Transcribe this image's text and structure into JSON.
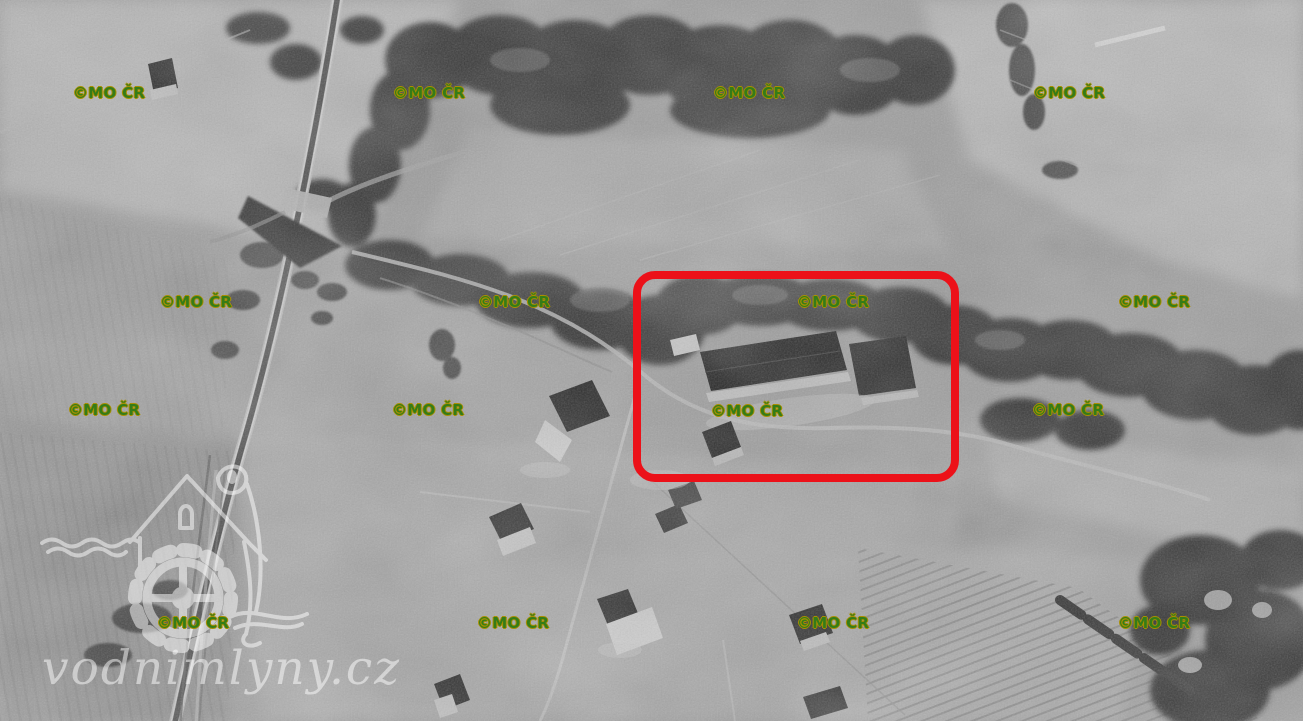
{
  "photo": {
    "kind": "historical black-and-white aerial photograph",
    "highlighted_feature": "water mill buildings"
  },
  "copyright_watermark": {
    "text": "©MO ČR",
    "fill_color": "#357c17",
    "outline_color": "#a98f00",
    "positions": [
      {
        "x": 73,
        "y": 86
      },
      {
        "x": 393,
        "y": 86
      },
      {
        "x": 713,
        "y": 86
      },
      {
        "x": 1033,
        "y": 86
      },
      {
        "x": 160,
        "y": 295
      },
      {
        "x": 478,
        "y": 295
      },
      {
        "x": 797,
        "y": 295
      },
      {
        "x": 1118,
        "y": 295
      },
      {
        "x": 68,
        "y": 403
      },
      {
        "x": 392,
        "y": 403
      },
      {
        "x": 711,
        "y": 404
      },
      {
        "x": 1032,
        "y": 403
      },
      {
        "x": 157,
        "y": 616
      },
      {
        "x": 477,
        "y": 616
      },
      {
        "x": 797,
        "y": 616
      },
      {
        "x": 1118,
        "y": 616
      }
    ]
  },
  "highlight_box": {
    "x": 633,
    "y": 271,
    "width": 326,
    "height": 211,
    "border_color": "#ec1119",
    "border_width": 8,
    "corner_radius": 22
  },
  "site_watermark": {
    "text": "vodnimlyny.cz",
    "color": "#ffffff",
    "opacity": 0.5,
    "icon": "watermill-logo"
  }
}
